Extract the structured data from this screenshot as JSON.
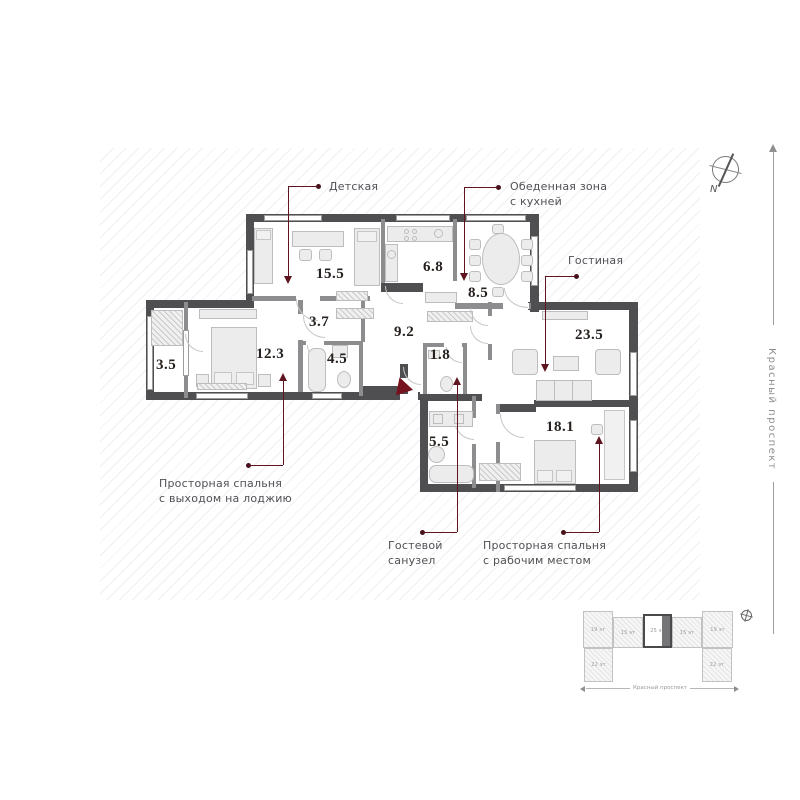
{
  "floorplan": {
    "areas": {
      "nursery": "15.5",
      "kitchen": "6.8",
      "dining": "8.5",
      "hall": "3.7",
      "corridor": "9.2",
      "bathroom": "4.5",
      "bedroom_1": "12.3",
      "loggia": "3.5",
      "wc": "1.8",
      "living": "23.5",
      "guest_bath": "5.5",
      "bedroom_2": "18.1"
    },
    "callouts": {
      "nursery": "Детская",
      "dining_l1": "Обеденная зона",
      "dining_l2": "с кухней",
      "living": "Гостиная",
      "bedroom1_l1": "Просторная спальня",
      "bedroom1_l2": "с выходом на лоджию",
      "guest_l1": "Гостевой",
      "guest_l2": "санузел",
      "bedroom2_l1": "Просторная спальня",
      "bedroom2_l2": "с рабочим местом"
    },
    "compass": "N",
    "street": "Красный проспект"
  },
  "site_plan": {
    "blocks": [
      {
        "label": "19 эт"
      },
      {
        "label": "15 эт"
      },
      {
        "label": "25 эт",
        "highlighted": true
      },
      {
        "label": "15 эт"
      },
      {
        "label": "19 эт"
      },
      {
        "label": "22 эт"
      },
      {
        "label": "22 эт"
      }
    ],
    "street": "Красный проспект"
  },
  "colors": {
    "wall": "#4f4f51",
    "leader": "#5e1520",
    "entrance": "#76121e"
  }
}
